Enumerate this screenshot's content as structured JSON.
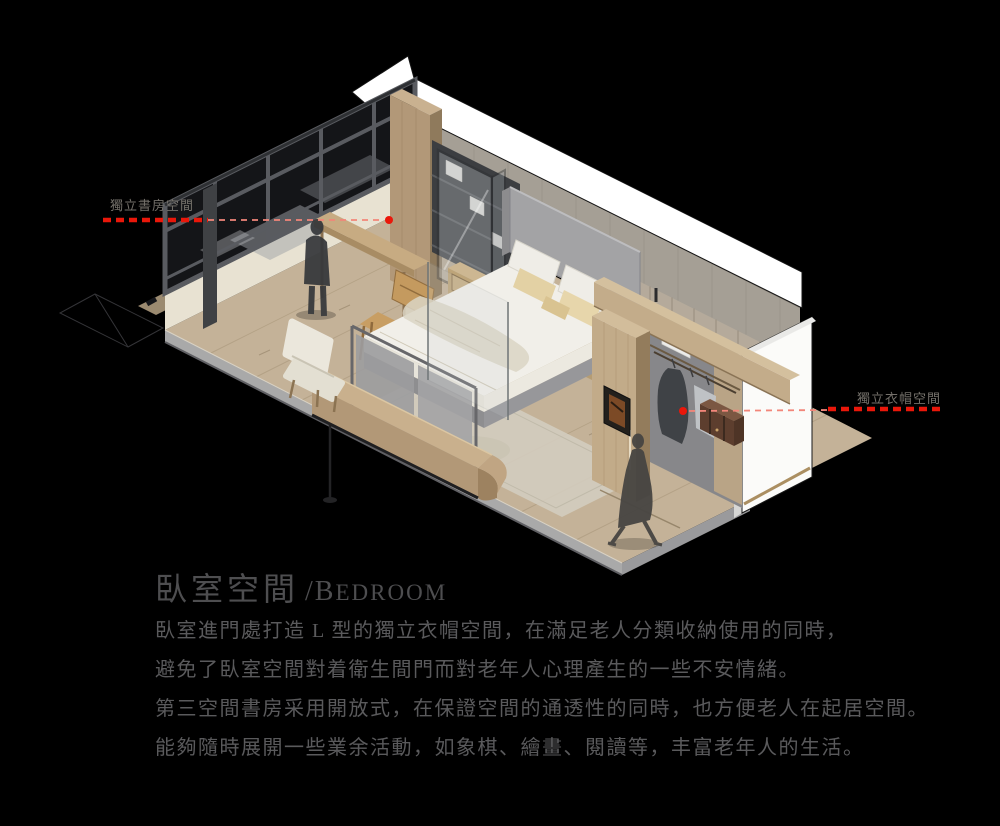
{
  "annotations": {
    "study_label": "獨立書房空間",
    "cloak_label": "獨立衣帽空間"
  },
  "heading": {
    "title_zh": "臥室空間",
    "title_en_initial": "/B",
    "title_en_rest": "EDROOM"
  },
  "body": {
    "lines": [
      "臥室進門處打造 L 型的獨立衣帽空間，在滿足老人分類收納使用的同時，",
      "避免了臥室空間對着衛生間門而對老年人心理產生的一些不安情緒。",
      "第三空間書房采用開放式，在保證空間的通透性的同時，也方便老人在起居空間。",
      "能夠隨時展開一些業余活動，如象棋、繪畫、閱讀等，丰富老年人的生活。"
    ]
  },
  "colors": {
    "accent_red": "#ea170a",
    "leader_thin_red": "#f2867a",
    "title_gray": "#4e4e50",
    "body_gray": "#5a5a5c",
    "label_gray": "#74706a",
    "floor_wood": "#c4b298",
    "window_frame_dark": "#46484c",
    "wall_panel": "#a59f95",
    "closet_wood": "#c2ab89",
    "cut_wall_white": "#ffffff",
    "background": "#000000"
  },
  "scene": {
    "type": "axonometric-bedroom-rendering"
  }
}
